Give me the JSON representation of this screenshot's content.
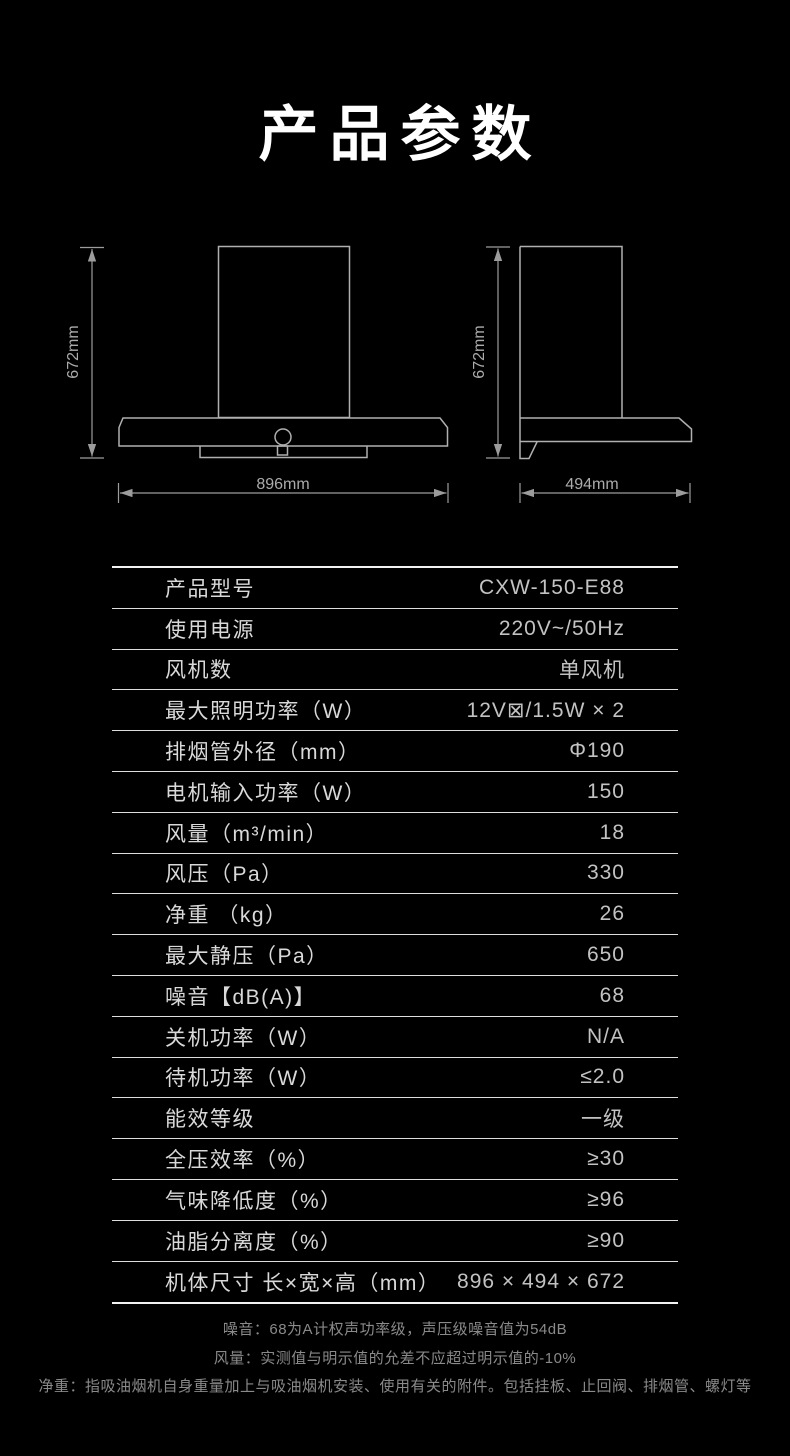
{
  "page": {
    "title": "产品参数"
  },
  "colors": {
    "background": "#000000",
    "title_text": "#ffffff",
    "table_border": "#f2f2f2",
    "row_divider": "#dedede",
    "label_text": "#d9d9d9",
    "value_text": "#c2c2c2",
    "diagram_line": "#b0b0b0",
    "dimension_text": "#ababab",
    "footnote_text": "#8a8a8a"
  },
  "diagrams": {
    "front_view": {
      "height_label": "672mm",
      "width_label": "896mm"
    },
    "side_view": {
      "height_label": "672mm",
      "depth_label": "494mm"
    }
  },
  "spec_table": {
    "rows": [
      {
        "label": "产品型号",
        "value": "CXW-150-E88"
      },
      {
        "label": "使用电源",
        "value": "220V~/50Hz"
      },
      {
        "label": "风机数",
        "value": "单风机"
      },
      {
        "label": "最大照明功率（W）",
        "value": "12V⊠/1.5W × 2"
      },
      {
        "label": "排烟管外径（mm）",
        "value": "Φ190"
      },
      {
        "label": "电机输入功率（W）",
        "value": "150"
      },
      {
        "label": "风量（m³/min）",
        "value": "18"
      },
      {
        "label": "风压（Pa）",
        "value": "330"
      },
      {
        "label": "净重 （kg）",
        "value": "26"
      },
      {
        "label": "最大静压（Pa）",
        "value": "650"
      },
      {
        "label": "噪音【dB(A)】",
        "value": "68"
      },
      {
        "label": "关机功率（W）",
        "value": "N/A"
      },
      {
        "label": "待机功率（W）",
        "value": "≤2.0"
      },
      {
        "label": "能效等级",
        "value": "一级"
      },
      {
        "label": "全压效率（%）",
        "value": "≥30"
      },
      {
        "label": "气味降低度（%）",
        "value": "≥96"
      },
      {
        "label": "油脂分离度（%）",
        "value": "≥90"
      },
      {
        "label": "机体尺寸 长×宽×高（mm）",
        "value": "896 × 494 × 672"
      }
    ]
  },
  "footnotes": [
    "噪音：68为A计权声功率级，声压级噪音值为54dB",
    "风量：实测值与明示值的允差不应超过明示值的-10%",
    "净重：指吸油烟机自身重量加上与吸油烟机安装、使用有关的附件。包括挂板、止回阀、排烟管、螺灯等"
  ]
}
